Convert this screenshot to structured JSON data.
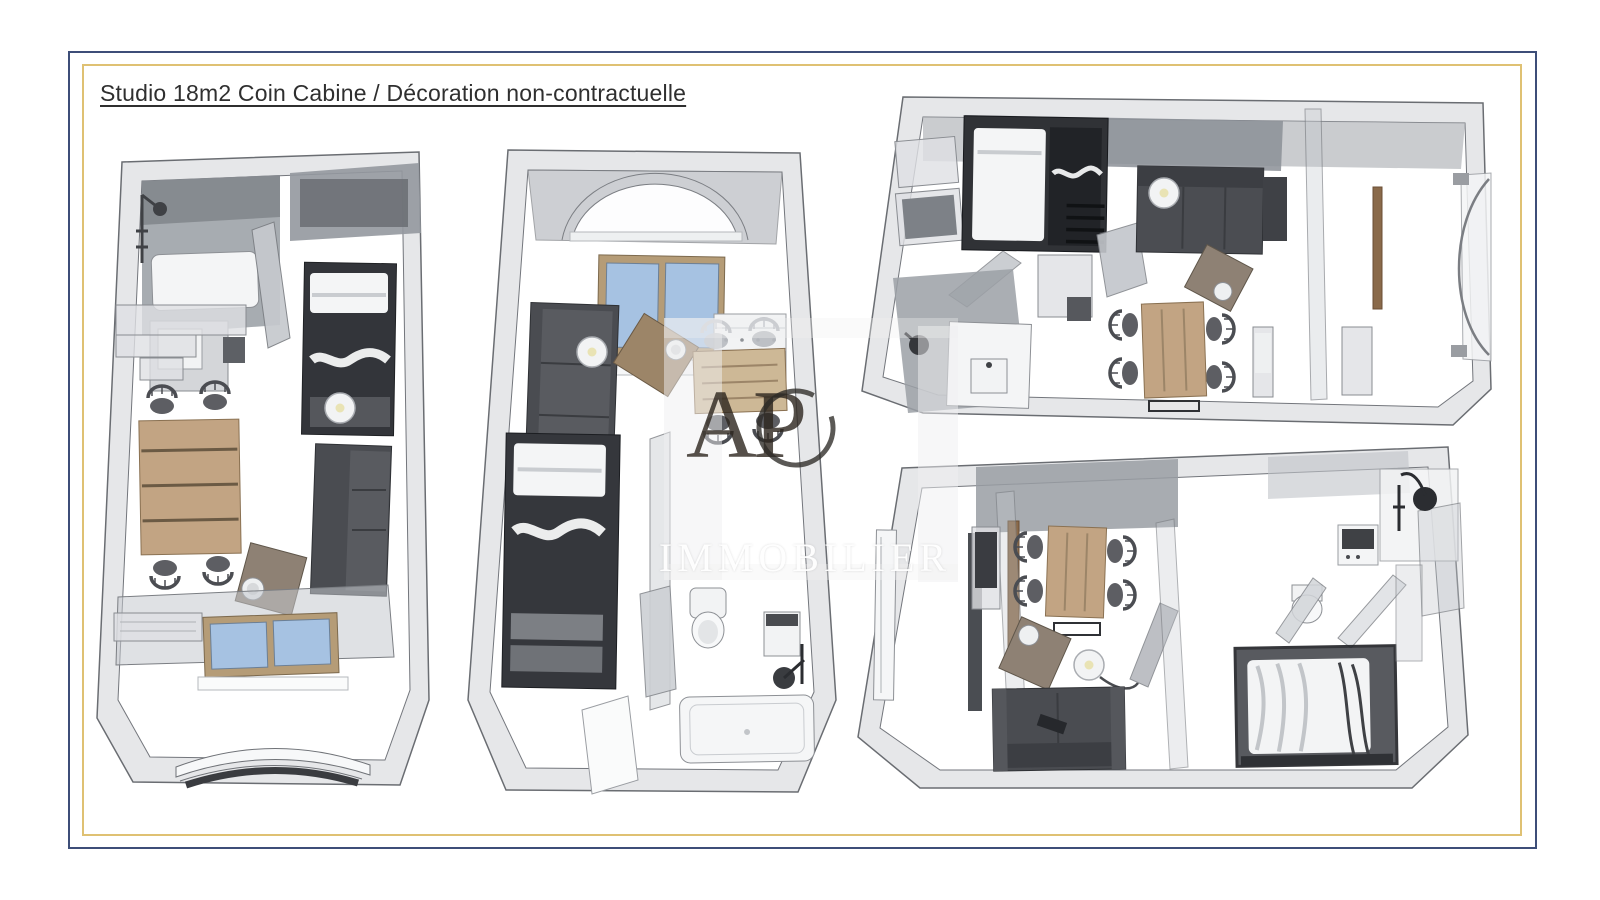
{
  "title": "Studio 18m2 Coin Cabine / Décoration non-contractuelle",
  "watermark": {
    "brand": "APC",
    "brand_letters": "AP",
    "subtitle": "IMMOBILIER"
  },
  "colors": {
    "border_outer_navy": "#3d4e78",
    "border_inner_gold": "#dfc173",
    "title_text": "#2f2f2f",
    "wall_translucent_gray": "#c5c8cd",
    "dark_furniture": "#4a4c51",
    "wood_table": "#c2a483",
    "window_glass_blue": "#a6c2e2",
    "watermark_brand": "#2c241d",
    "watermark_subtitle": "#ffffff"
  }
}
